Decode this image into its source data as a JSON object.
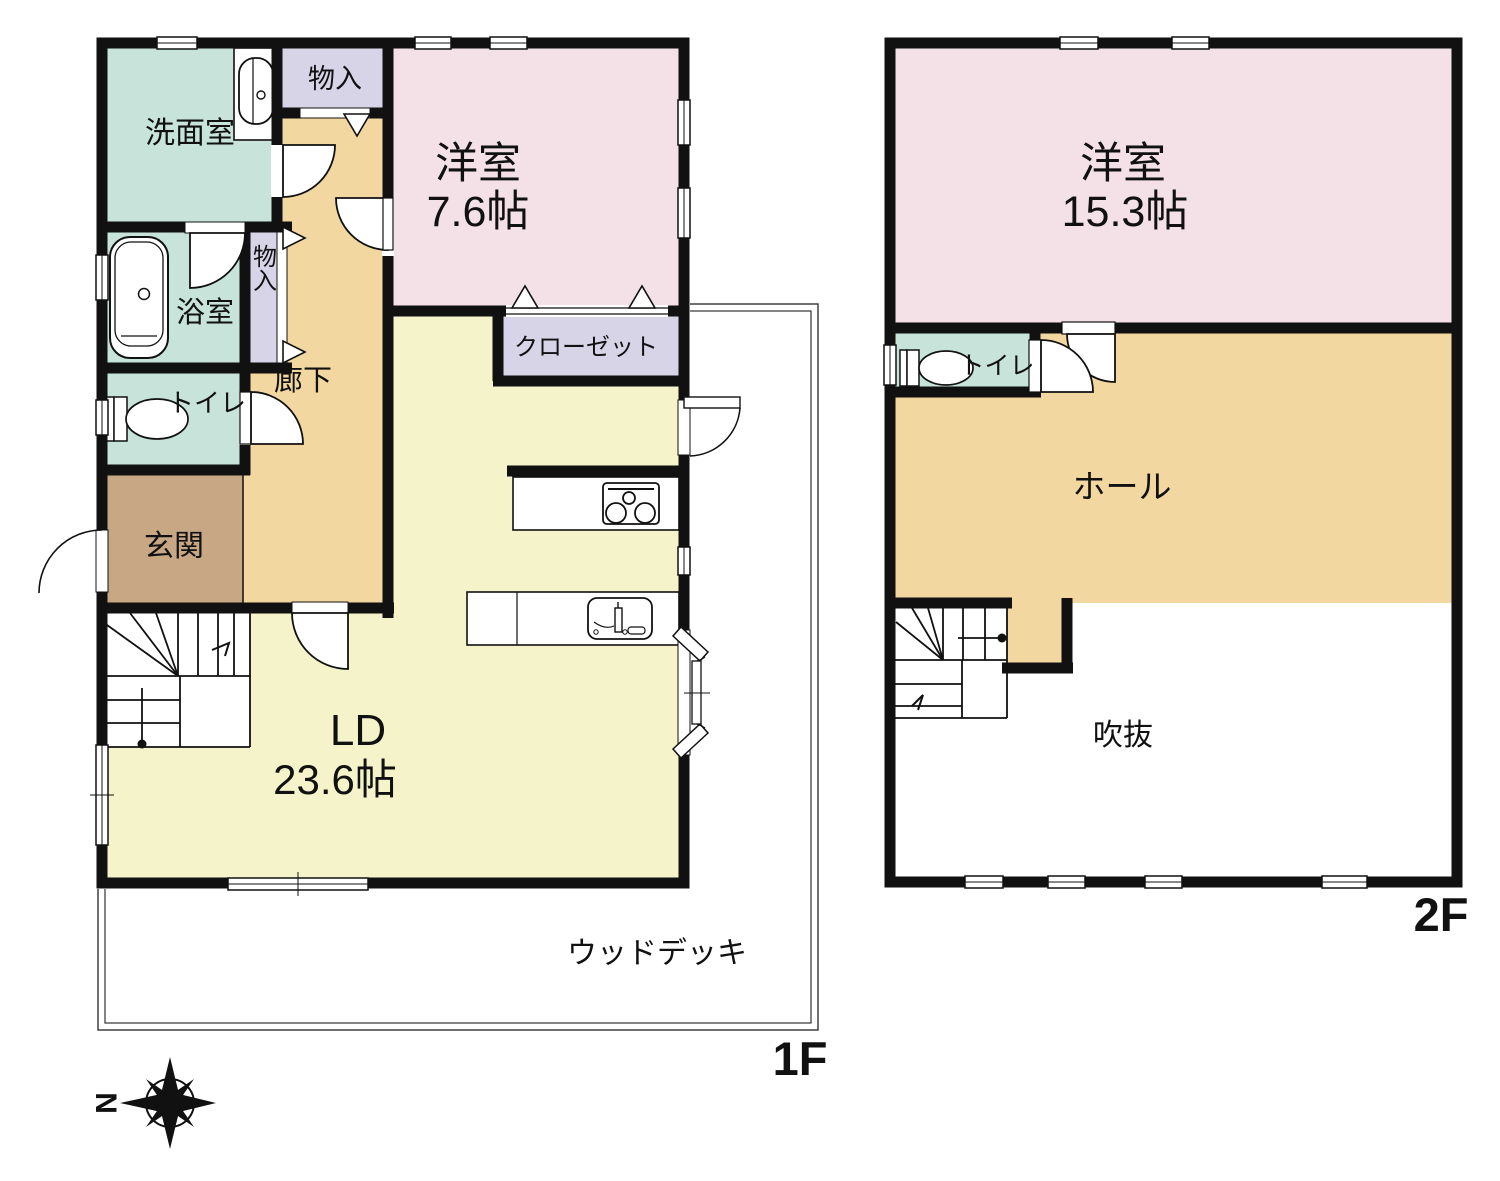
{
  "title": "住宅間取り図 (1F / 2F)",
  "f1": {
    "label": "1F",
    "washroom": "洗面室",
    "storage_top": "物入",
    "storage_side": "物入",
    "western_name": "洋室",
    "western_size": "7.6帖",
    "bath": "浴室",
    "hallway": "廊下",
    "closet": "クローゼット",
    "toilet": "トイレ",
    "entrance": "玄関",
    "ld_name": "LD",
    "ld_size": "23.6帖",
    "deck": "ウッドデッキ"
  },
  "f2": {
    "label": "2F",
    "western_name": "洋室",
    "western_size": "15.3帖",
    "toilet": "トイレ",
    "hall": "ホール",
    "void": "吹抜"
  },
  "compass": {
    "north": "N"
  },
  "colors": {
    "wall": "#111111",
    "room_teal": "#c7e3da",
    "room_lavender": "#d7d4e8",
    "room_pink": "#f3e1e7",
    "room_tan": "#f3d7a1",
    "room_yellow": "#f5f3ca",
    "room_brown": "#c7a784"
  }
}
